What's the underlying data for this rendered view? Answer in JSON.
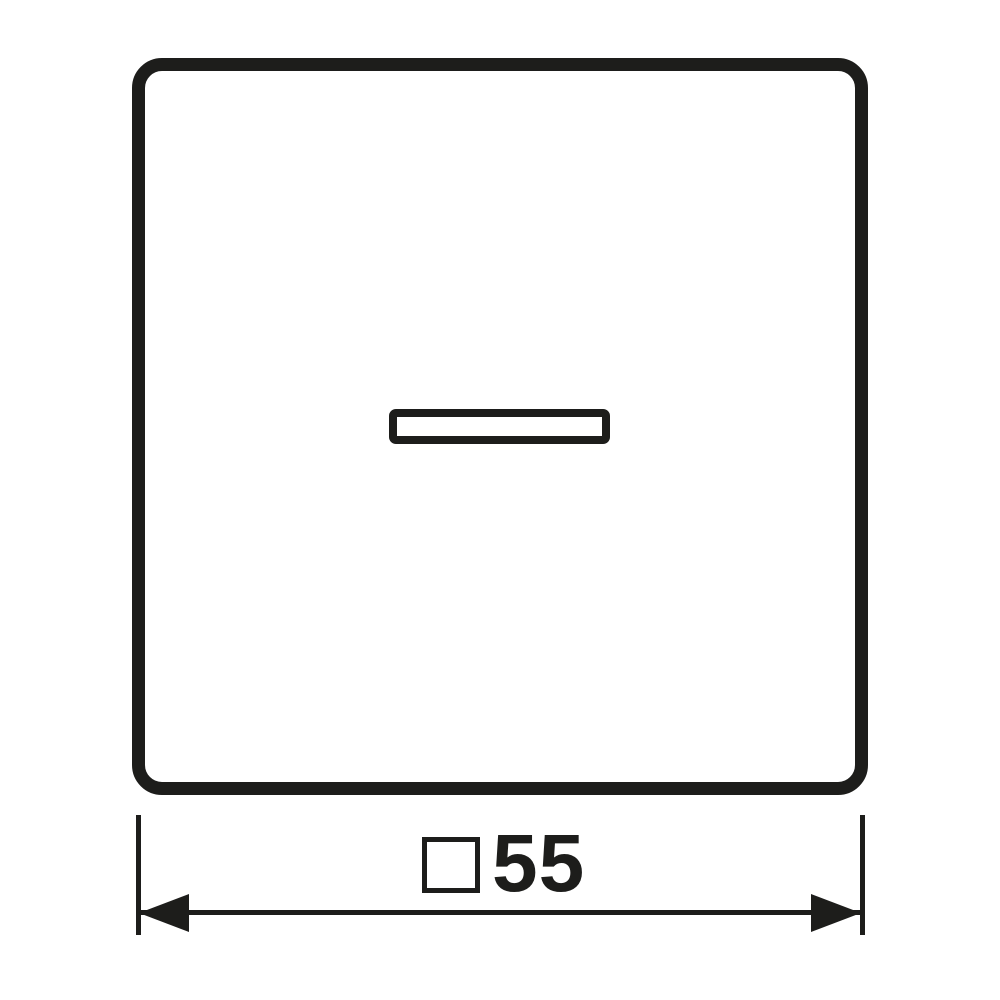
{
  "drawing": {
    "type": "product-dimension-diagram",
    "subject": "square rocker plate with indicator lens window",
    "dimension": {
      "label": "□55",
      "symbol": "□",
      "symbol_meaning": "square-dimension-icon",
      "value": "55"
    }
  },
  "colors": {
    "line": "#1d1d1b",
    "background": "#ffffff"
  }
}
